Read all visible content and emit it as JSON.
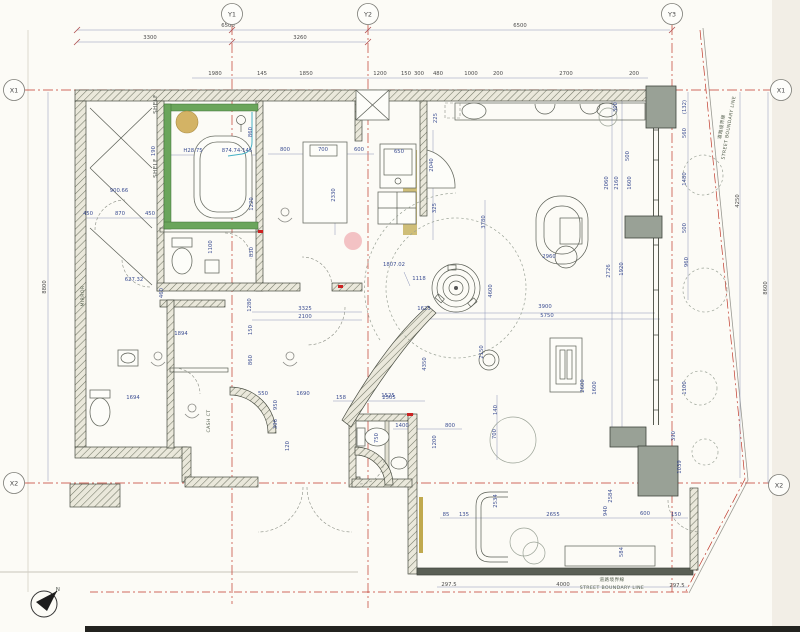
{
  "colors": {
    "paper": "#fcfbf6",
    "grid_red": "#c0392b",
    "dimension_blue": "#3d4f93",
    "dark_dim": "#4c4c4c",
    "wall_hatch": "#707465",
    "tile_green": "#5f9e50",
    "counter_olive": "#c0a94e",
    "accent_pink": "#f3c2c4",
    "accent_tan": "#d3b365",
    "column_gray": "#99a196"
  },
  "grid": {
    "bubbles": [
      {
        "label": "Y1",
        "x": 232,
        "y": 14
      },
      {
        "label": "Y2",
        "x": 368,
        "y": 14
      },
      {
        "label": "Y3",
        "x": 672,
        "y": 14
      },
      {
        "label": "X1",
        "x": 14,
        "y": 90
      },
      {
        "label": "X1",
        "x": 781,
        "y": 90
      },
      {
        "label": "X2",
        "x": 14,
        "y": 483
      },
      {
        "label": "X2",
        "x": 779,
        "y": 485
      }
    ]
  },
  "labels": [
    {
      "t": "SHELF",
      "x": 157,
      "y": 104,
      "r": -90
    },
    {
      "t": "SHELF",
      "x": 157,
      "y": 168,
      "r": -90
    },
    {
      "t": "MIRROR",
      "x": 84,
      "y": 296,
      "r": -90,
      "s": "tiny"
    },
    {
      "t": "CASH CT",
      "x": 210,
      "y": 421,
      "r": -90,
      "s": "tiny"
    },
    {
      "t": "道路境界線",
      "x": 723,
      "y": 127,
      "r": -80,
      "s": "tiny"
    },
    {
      "t": "STREET BOUNDARY LINE",
      "x": 730,
      "y": 128,
      "r": -80,
      "s": "tiny"
    },
    {
      "t": "道路境界線",
      "x": 612,
      "y": 581,
      "s": "tiny"
    },
    {
      "t": "STREET BOUNDARY LINE",
      "x": 612,
      "y": 589,
      "s": "tiny"
    },
    {
      "t": "N",
      "x": 58,
      "y": 591
    }
  ],
  "dims": [
    {
      "t": "6500",
      "x": 228,
      "y": 27,
      "c": "d"
    },
    {
      "t": "6500",
      "x": 520,
      "y": 27,
      "c": "d"
    },
    {
      "t": "3300",
      "x": 150,
      "y": 39,
      "c": "d"
    },
    {
      "t": "3260",
      "x": 300,
      "y": 39,
      "c": "d"
    },
    {
      "t": "1980",
      "x": 215,
      "y": 75,
      "c": "d"
    },
    {
      "t": "145",
      "x": 262,
      "y": 75,
      "c": "d"
    },
    {
      "t": "1850",
      "x": 306,
      "y": 75,
      "c": "d"
    },
    {
      "t": "1200",
      "x": 380,
      "y": 75,
      "c": "d"
    },
    {
      "t": "150",
      "x": 406,
      "y": 75,
      "c": "d"
    },
    {
      "t": "300",
      "x": 419,
      "y": 75,
      "c": "d"
    },
    {
      "t": "480",
      "x": 438,
      "y": 75,
      "c": "d"
    },
    {
      "t": "1000",
      "x": 471,
      "y": 75,
      "c": "d"
    },
    {
      "t": "200",
      "x": 498,
      "y": 75,
      "c": "d"
    },
    {
      "t": "2700",
      "x": 566,
      "y": 75,
      "c": "d"
    },
    {
      "t": "200",
      "x": 634,
      "y": 75,
      "c": "d"
    },
    {
      "t": "8800",
      "x": 46,
      "y": 287,
      "r": -90,
      "c": "d"
    },
    {
      "t": "900.66",
      "x": 119,
      "y": 192
    },
    {
      "t": "450",
      "x": 88,
      "y": 215
    },
    {
      "t": "870",
      "x": 120,
      "y": 215
    },
    {
      "t": "450",
      "x": 150,
      "y": 215
    },
    {
      "t": "627.32",
      "x": 134,
      "y": 281
    },
    {
      "t": "H28.75",
      "x": 193,
      "y": 152
    },
    {
      "t": "874.74-145",
      "x": 237,
      "y": 152
    },
    {
      "t": "860",
      "x": 252,
      "y": 132,
      "r": -90
    },
    {
      "t": "190",
      "x": 155,
      "y": 151,
      "r": -90
    },
    {
      "t": "1220",
      "x": 253,
      "y": 204,
      "r": -90
    },
    {
      "t": "1100",
      "x": 212,
      "y": 247,
      "r": -90
    },
    {
      "t": "830",
      "x": 253,
      "y": 252,
      "r": -90
    },
    {
      "t": "800",
      "x": 285,
      "y": 151
    },
    {
      "t": "700",
      "x": 323,
      "y": 151
    },
    {
      "t": "600",
      "x": 359,
      "y": 151
    },
    {
      "t": "650",
      "x": 399,
      "y": 153
    },
    {
      "t": "2330",
      "x": 335,
      "y": 195,
      "r": -90
    },
    {
      "t": "225",
      "x": 437,
      "y": 118,
      "r": -90
    },
    {
      "t": "2040",
      "x": 433,
      "y": 165,
      "r": -90
    },
    {
      "t": "325",
      "x": 436,
      "y": 208,
      "r": -90
    },
    {
      "t": "460",
      "x": 163,
      "y": 293,
      "r": -90
    },
    {
      "t": "1280",
      "x": 251,
      "y": 305,
      "r": -90
    },
    {
      "t": "150",
      "x": 252,
      "y": 330,
      "r": -90
    },
    {
      "t": "860",
      "x": 252,
      "y": 360,
      "r": -90
    },
    {
      "t": "1894",
      "x": 181,
      "y": 335
    },
    {
      "t": "1694",
      "x": 133,
      "y": 399
    },
    {
      "t": "3325",
      "x": 305,
      "y": 310
    },
    {
      "t": "2100",
      "x": 305,
      "y": 318
    },
    {
      "t": "550",
      "x": 263,
      "y": 395
    },
    {
      "t": "1690",
      "x": 303,
      "y": 395
    },
    {
      "t": "950",
      "x": 277,
      "y": 405,
      "r": -90
    },
    {
      "t": "396",
      "x": 277,
      "y": 424,
      "r": -90
    },
    {
      "t": "120",
      "x": 289,
      "y": 446,
      "r": -90
    },
    {
      "t": "1807.02",
      "x": 394,
      "y": 266
    },
    {
      "t": "1118",
      "x": 419,
      "y": 280
    },
    {
      "t": "1625",
      "x": 424,
      "y": 310
    },
    {
      "t": "3780",
      "x": 485,
      "y": 222,
      "r": -90
    },
    {
      "t": "4600",
      "x": 492,
      "y": 291,
      "r": -90
    },
    {
      "t": "2150",
      "x": 483,
      "y": 352,
      "r": -90
    },
    {
      "t": "4350",
      "x": 426,
      "y": 364,
      "r": -90
    },
    {
      "t": "3900",
      "x": 545,
      "y": 308
    },
    {
      "t": "5750",
      "x": 547,
      "y": 317
    },
    {
      "t": "2960",
      "x": 549,
      "y": 258
    },
    {
      "t": "1525",
      "x": 388,
      "y": 397
    },
    {
      "t": "2060",
      "x": 608,
      "y": 183,
      "r": -90
    },
    {
      "t": "2160",
      "x": 618,
      "y": 183,
      "r": -90
    },
    {
      "t": "1600",
      "x": 631,
      "y": 183,
      "r": -90
    },
    {
      "t": "500",
      "x": 629,
      "y": 156,
      "r": -90
    },
    {
      "t": "300",
      "x": 617,
      "y": 107,
      "r": -90
    },
    {
      "t": "2726",
      "x": 610,
      "y": 271,
      "r": -90
    },
    {
      "t": "1920",
      "x": 623,
      "y": 269,
      "r": -90
    },
    {
      "t": "(132)",
      "x": 686,
      "y": 107,
      "r": -90
    },
    {
      "t": "560",
      "x": 686,
      "y": 133,
      "r": -90
    },
    {
      "t": "1480",
      "x": 686,
      "y": 179,
      "r": -90
    },
    {
      "t": "500",
      "x": 686,
      "y": 228,
      "r": -90
    },
    {
      "t": "960",
      "x": 688,
      "y": 262,
      "r": -90
    },
    {
      "t": "4250",
      "x": 739,
      "y": 201,
      "r": -90,
      "c": "d"
    },
    {
      "t": "8600",
      "x": 767,
      "y": 288,
      "r": -90,
      "c": "d"
    },
    {
      "t": "2600",
      "x": 584,
      "y": 386,
      "r": -90
    },
    {
      "t": "1600",
      "x": 596,
      "y": 388,
      "r": -90
    },
    {
      "t": "1100",
      "x": 686,
      "y": 388,
      "r": -90
    },
    {
      "t": "390",
      "x": 675,
      "y": 436,
      "r": -90
    },
    {
      "t": "1039",
      "x": 681,
      "y": 467,
      "r": -90
    },
    {
      "t": "2584",
      "x": 612,
      "y": 496,
      "r": -90
    },
    {
      "t": "940",
      "x": 607,
      "y": 511,
      "r": -90
    },
    {
      "t": "600",
      "x": 645,
      "y": 515
    },
    {
      "t": "150",
      "x": 676,
      "y": 516
    },
    {
      "t": "584",
      "x": 623,
      "y": 552,
      "r": -90
    },
    {
      "t": "2534",
      "x": 497,
      "y": 501,
      "r": -90
    },
    {
      "t": "2655",
      "x": 553,
      "y": 516
    },
    {
      "t": "85",
      "x": 446,
      "y": 516
    },
    {
      "t": "135",
      "x": 464,
      "y": 516
    },
    {
      "t": "140",
      "x": 497,
      "y": 410,
      "r": -90
    },
    {
      "t": "700",
      "x": 496,
      "y": 434,
      "r": -90
    },
    {
      "t": "158",
      "x": 341,
      "y": 399
    },
    {
      "t": "2505",
      "x": 389,
      "y": 399
    },
    {
      "t": "1400",
      "x": 402,
      "y": 427
    },
    {
      "t": "800",
      "x": 450,
      "y": 427
    },
    {
      "t": "750",
      "x": 378,
      "y": 438,
      "r": -90
    },
    {
      "t": "1200",
      "x": 436,
      "y": 442,
      "r": -90
    },
    {
      "t": "297.5",
      "x": 449,
      "y": 586,
      "c": "d"
    },
    {
      "t": "4000",
      "x": 563,
      "y": 586,
      "c": "d"
    },
    {
      "t": "297.5",
      "x": 677,
      "y": 587,
      "c": "d"
    }
  ]
}
